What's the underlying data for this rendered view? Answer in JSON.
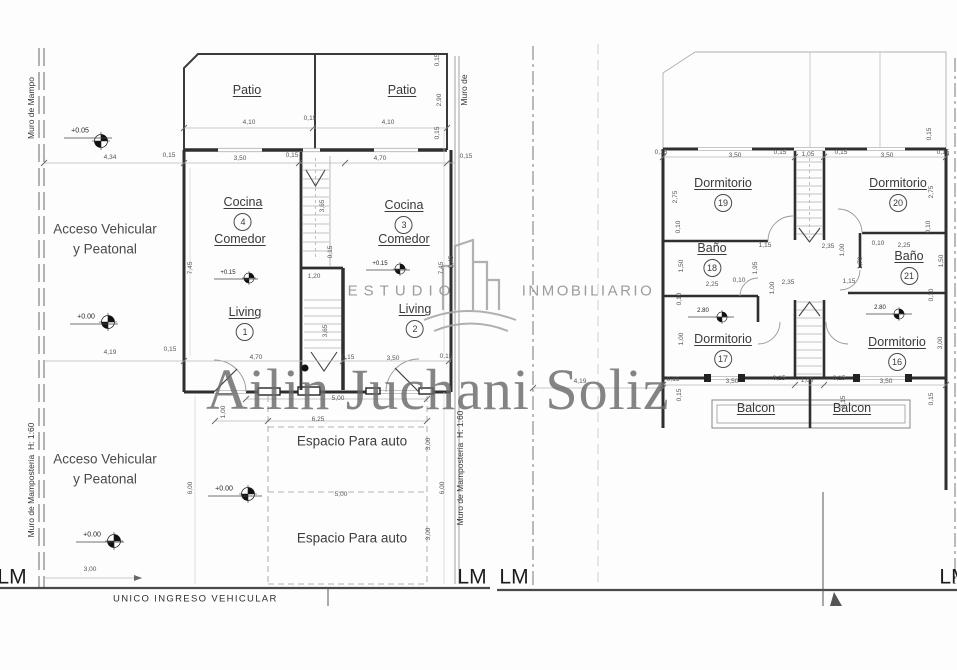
{
  "watermark": {
    "name": "Ailin Juchani Soliz"
  },
  "brand": {
    "left": "ESTUDIO",
    "right": "INMOBILIARIO"
  },
  "rooms": [
    {
      "name": "Patio",
      "x": 247,
      "y": 84
    },
    {
      "name": "Patio",
      "x": 402,
      "y": 84
    },
    {
      "name": "Cocina",
      "num": "4",
      "x": 243,
      "y": 196
    },
    {
      "name": "Comedor",
      "x": 240,
      "y": 233
    },
    {
      "name": "Living",
      "num": "1",
      "x": 245,
      "y": 306
    },
    {
      "name": "Cocina",
      "num": "3",
      "x": 404,
      "y": 199
    },
    {
      "name": "Comedor",
      "x": 404,
      "y": 233
    },
    {
      "name": "Living",
      "num": "2",
      "x": 415,
      "y": 303
    },
    {
      "name": "Dormitorio",
      "num": "19",
      "x": 723,
      "y": 177
    },
    {
      "name": "Dormitorio",
      "num": "20",
      "x": 898,
      "y": 177
    },
    {
      "name": "Baño",
      "num": "18",
      "x": 712,
      "y": 242
    },
    {
      "name": "Baño",
      "num": "21",
      "x": 909,
      "y": 250
    },
    {
      "name": "Dormitorio",
      "num": "17",
      "x": 723,
      "y": 333
    },
    {
      "name": "Dormitorio",
      "num": "16",
      "x": 897,
      "y": 336
    },
    {
      "name": "Balcon",
      "x": 756,
      "y": 402
    },
    {
      "name": "Balcon",
      "x": 852,
      "y": 402
    }
  ],
  "labels": [
    {
      "t": "4,34",
      "x": 110,
      "y": 158
    },
    {
      "t": "0,15",
      "x": 169,
      "y": 156
    },
    {
      "t": "4,10",
      "x": 249,
      "y": 123
    },
    {
      "t": "0,15",
      "x": 310,
      "y": 119
    },
    {
      "t": "4,10",
      "x": 388,
      "y": 123
    },
    {
      "t": "0,15",
      "x": 438,
      "y": 60,
      "v": 1
    },
    {
      "t": "2,90",
      "x": 440,
      "y": 100,
      "v": 1
    },
    {
      "t": "0,15",
      "x": 438,
      "y": 133,
      "v": 1
    },
    {
      "t": "3,50",
      "x": 240,
      "y": 159
    },
    {
      "t": "0,15",
      "x": 292,
      "y": 156
    },
    {
      "t": "4,70",
      "x": 380,
      "y": 159
    },
    {
      "t": "0,15",
      "x": 466,
      "y": 157
    },
    {
      "t": "7,45",
      "x": 191,
      "y": 268,
      "v": 1
    },
    {
      "t": "7,45",
      "x": 442,
      "y": 268,
      "v": 1
    },
    {
      "t": "2,45",
      "x": 452,
      "y": 262,
      "v": 1
    },
    {
      "t": "3,65",
      "x": 323,
      "y": 206,
      "v": 1
    },
    {
      "t": "0,15",
      "x": 331,
      "y": 252,
      "v": 1
    },
    {
      "t": "1,20",
      "x": 314,
      "y": 277
    },
    {
      "t": "3,65",
      "x": 326,
      "y": 331,
      "v": 1
    },
    {
      "t": "0,15",
      "x": 348,
      "y": 358
    },
    {
      "t": "4,19",
      "x": 110,
      "y": 353
    },
    {
      "t": "0,15",
      "x": 170,
      "y": 350
    },
    {
      "t": "4,70",
      "x": 256,
      "y": 358
    },
    {
      "t": "3,50",
      "x": 393,
      "y": 359
    },
    {
      "t": "0,15",
      "x": 446,
      "y": 357
    },
    {
      "t": "1,00",
      "x": 224,
      "y": 412,
      "v": 1
    },
    {
      "t": "5,00",
      "x": 338,
      "y": 399
    },
    {
      "t": "6,25",
      "x": 318,
      "y": 420
    },
    {
      "t": "5,00",
      "x": 341,
      "y": 495
    },
    {
      "t": "3,00",
      "x": 429,
      "y": 444,
      "v": 1
    },
    {
      "t": "3,00",
      "x": 429,
      "y": 534,
      "v": 1
    },
    {
      "t": "6,00",
      "x": 191,
      "y": 488,
      "v": 1
    },
    {
      "t": "6,00",
      "x": 443,
      "y": 488,
      "v": 1
    },
    {
      "t": "3,00",
      "x": 90,
      "y": 570
    },
    {
      "t": "4,19",
      "x": 580,
      "y": 382
    },
    {
      "t": "0,15",
      "x": 661,
      "y": 153
    },
    {
      "t": "3,50",
      "x": 735,
      "y": 156
    },
    {
      "t": "0,15",
      "x": 780,
      "y": 153
    },
    {
      "t": "1,05",
      "x": 808,
      "y": 155
    },
    {
      "t": "0,15",
      "x": 841,
      "y": 153
    },
    {
      "t": "3,50",
      "x": 887,
      "y": 156
    },
    {
      "t": "0,15",
      "x": 943,
      "y": 153
    },
    {
      "t": "0,15",
      "x": 930,
      "y": 134,
      "v": 1
    },
    {
      "t": "2,75",
      "x": 676,
      "y": 197,
      "v": 1
    },
    {
      "t": "0,10",
      "x": 679,
      "y": 227,
      "v": 1
    },
    {
      "t": "2,75",
      "x": 932,
      "y": 192,
      "v": 1
    },
    {
      "t": "0,10",
      "x": 929,
      "y": 227,
      "v": 1
    },
    {
      "t": "1,15",
      "x": 765,
      "y": 246
    },
    {
      "t": "2,35",
      "x": 828,
      "y": 247
    },
    {
      "t": "1,00",
      "x": 843,
      "y": 250,
      "v": 1
    },
    {
      "t": "0,10",
      "x": 878,
      "y": 244
    },
    {
      "t": "2,25",
      "x": 904,
      "y": 246
    },
    {
      "t": "1,50",
      "x": 682,
      "y": 266,
      "v": 1
    },
    {
      "t": "1,95",
      "x": 756,
      "y": 268,
      "v": 1
    },
    {
      "t": "2,25",
      "x": 712,
      "y": 285
    },
    {
      "t": "0,10",
      "x": 739,
      "y": 281
    },
    {
      "t": "1,00",
      "x": 773,
      "y": 288,
      "v": 1
    },
    {
      "t": "2,35",
      "x": 788,
      "y": 283
    },
    {
      "t": "1,15",
      "x": 849,
      "y": 282
    },
    {
      "t": "1,70",
      "x": 861,
      "y": 263,
      "v": 1
    },
    {
      "t": "1,50",
      "x": 942,
      "y": 261,
      "v": 1
    },
    {
      "t": "0,10",
      "x": 680,
      "y": 299,
      "v": 1
    },
    {
      "t": "0,10",
      "x": 932,
      "y": 295,
      "v": 1
    },
    {
      "t": "1,00",
      "x": 682,
      "y": 339,
      "v": 1
    },
    {
      "t": "3,00",
      "x": 941,
      "y": 343,
      "v": 1
    },
    {
      "t": "3,50",
      "x": 732,
      "y": 382
    },
    {
      "t": "0,15",
      "x": 779,
      "y": 379
    },
    {
      "t": "1,05",
      "x": 807,
      "y": 381
    },
    {
      "t": "0,15",
      "x": 839,
      "y": 379
    },
    {
      "t": "3,50",
      "x": 886,
      "y": 382
    },
    {
      "t": "0,15",
      "x": 673,
      "y": 380
    },
    {
      "t": "0,15",
      "x": 680,
      "y": 395,
      "v": 1
    },
    {
      "t": "0,15",
      "x": 932,
      "y": 399,
      "v": 1
    },
    {
      "t": "0,15",
      "x": 844,
      "y": 402,
      "v": 1
    },
    {
      "t": "+0.05",
      "x": 80,
      "y": 131,
      "cls": "lvl",
      "name": "level-label"
    },
    {
      "t": "+0.00",
      "x": 86,
      "y": 317,
      "cls": "lvl",
      "name": "level-label"
    },
    {
      "t": "+0.00",
      "x": 92,
      "y": 535,
      "cls": "lvl",
      "name": "level-label"
    },
    {
      "t": "+0.00",
      "x": 224,
      "y": 489,
      "cls": "lvl",
      "name": "level-label"
    },
    {
      "t": "+0.15",
      "x": 228,
      "y": 273,
      "cls": "lvls",
      "name": "level-label"
    },
    {
      "t": "+0.15",
      "x": 380,
      "y": 264,
      "cls": "lvls",
      "name": "level-label"
    },
    {
      "t": "2.80",
      "x": 703,
      "y": 311,
      "cls": "lvls",
      "name": "level-label"
    },
    {
      "t": "2.80",
      "x": 880,
      "y": 308,
      "cls": "lvls",
      "name": "level-label"
    },
    {
      "t": "Acceso Vehicular\ny Peatonal",
      "x": 105,
      "y": 239,
      "cls": "access",
      "name": "access-label"
    },
    {
      "t": "Acceso Vehicular\ny Peatonal",
      "x": 105,
      "y": 469,
      "cls": "access",
      "name": "access-label"
    },
    {
      "t": "Espacio Para auto",
      "x": 352,
      "y": 441,
      "cls": "space",
      "name": "parking-label"
    },
    {
      "t": "Espacio Para auto",
      "x": 352,
      "y": 538,
      "cls": "space",
      "name": "parking-label"
    },
    {
      "t": "UNICO INGRESO VEHICULAR",
      "x": 113,
      "y": 599,
      "cls": "street",
      "name": "street-label"
    },
    {
      "t": "LM",
      "x": 12,
      "y": 577,
      "cls": "lm",
      "name": "lm-label"
    },
    {
      "t": "LM",
      "x": 472,
      "y": 577,
      "cls": "lm",
      "name": "lm-label"
    },
    {
      "t": "LM",
      "x": 514,
      "y": 577,
      "cls": "lm",
      "name": "lm-label"
    },
    {
      "t": "LM",
      "x": 954,
      "y": 577,
      "cls": "lm",
      "name": "lm-label"
    },
    {
      "t": "Muro de Mampo",
      "x": 31,
      "y": 108,
      "v": 1,
      "cls": "muro",
      "name": "wall-note"
    },
    {
      "t": "Muro de Mamposteria  H: 1:60",
      "x": 31,
      "y": 480,
      "v": 1,
      "cls": "muro",
      "name": "wall-note"
    },
    {
      "t": "Muro de",
      "x": 464,
      "y": 90,
      "v": 1,
      "cls": "muro",
      "name": "wall-note"
    },
    {
      "t": "Muro de Mamposteria  H: 1:60",
      "x": 460,
      "y": 468,
      "v": 1,
      "cls": "muro",
      "name": "wall-note"
    },
    {
      "t": "ESTUDIO",
      "x": 402,
      "y": 291,
      "cls": "brand-l",
      "name": "logo-text-estudio"
    },
    {
      "t": "INMOBILIARIO",
      "x": 588,
      "y": 291,
      "cls": "brand-r",
      "name": "logo-text-inmobiliario"
    }
  ]
}
